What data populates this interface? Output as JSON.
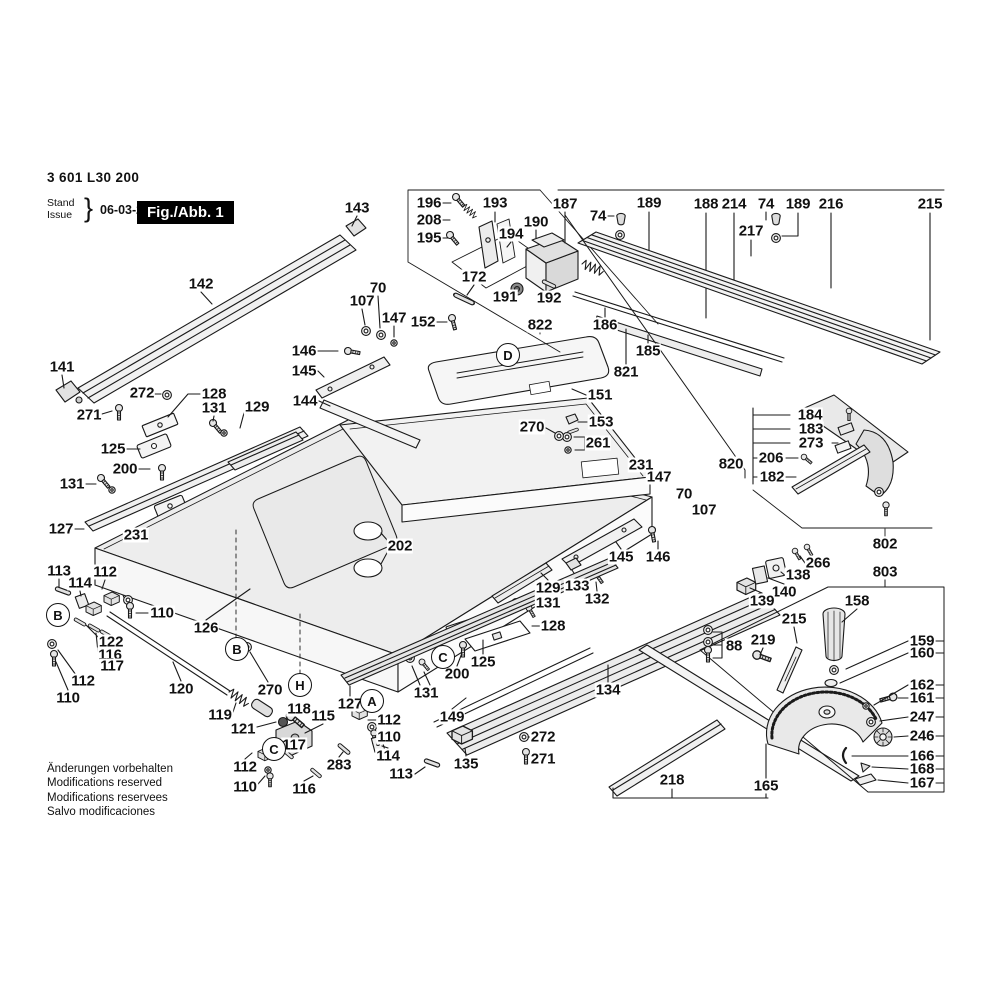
{
  "header": {
    "part_number": "3 601 L30 200",
    "stand_label": "Stand",
    "issue_label": "Issue",
    "brace": "}",
    "date": "06-03-21",
    "figure_label": "Fig./Abb. 1"
  },
  "footer": {
    "lines": [
      "Änderungen vorbehalten",
      "Modifications reserved",
      "Modifications reservees",
      "Salvo modificaciones"
    ]
  },
  "colors": {
    "ink": "#1a1a1a",
    "paper": "#ffffff",
    "badge_bg": "#000000",
    "badge_fg": "#ffffff"
  },
  "part_labels": [
    {
      "t": "143",
      "x": 357,
      "y": 208
    },
    {
      "t": "196",
      "x": 429,
      "y": 203
    },
    {
      "t": "208",
      "x": 429,
      "y": 220
    },
    {
      "t": "195",
      "x": 429,
      "y": 238
    },
    {
      "t": "193",
      "x": 495,
      "y": 203
    },
    {
      "t": "190",
      "x": 536,
      "y": 222
    },
    {
      "t": "194",
      "x": 511,
      "y": 234
    },
    {
      "t": "187",
      "x": 565,
      "y": 204
    },
    {
      "t": "74",
      "x": 598,
      "y": 216
    },
    {
      "t": "189",
      "x": 649,
      "y": 203
    },
    {
      "t": "188",
      "x": 706,
      "y": 204
    },
    {
      "t": "214",
      "x": 734,
      "y": 204
    },
    {
      "t": "74",
      "x": 766,
      "y": 204
    },
    {
      "t": "189",
      "x": 798,
      "y": 204
    },
    {
      "t": "216",
      "x": 831,
      "y": 204
    },
    {
      "t": "215",
      "x": 930,
      "y": 204
    },
    {
      "t": "217",
      "x": 751,
      "y": 231
    },
    {
      "t": "172",
      "x": 474,
      "y": 277
    },
    {
      "t": "191",
      "x": 505,
      "y": 297
    },
    {
      "t": "192",
      "x": 549,
      "y": 298
    },
    {
      "t": "142",
      "x": 201,
      "y": 284
    },
    {
      "t": "70",
      "x": 378,
      "y": 288
    },
    {
      "t": "107",
      "x": 362,
      "y": 301
    },
    {
      "t": "147",
      "x": 394,
      "y": 318
    },
    {
      "t": "152",
      "x": 423,
      "y": 322
    },
    {
      "t": "822",
      "x": 540,
      "y": 325
    },
    {
      "t": "186",
      "x": 605,
      "y": 325
    },
    {
      "t": "185",
      "x": 648,
      "y": 351
    },
    {
      "t": "821",
      "x": 626,
      "y": 372
    },
    {
      "t": "146",
      "x": 304,
      "y": 351
    },
    {
      "t": "145",
      "x": 304,
      "y": 371
    },
    {
      "t": "144",
      "x": 305,
      "y": 401
    },
    {
      "t": "151",
      "x": 600,
      "y": 395
    },
    {
      "t": "153",
      "x": 601,
      "y": 422
    },
    {
      "t": "261",
      "x": 598,
      "y": 443
    },
    {
      "t": "270",
      "x": 532,
      "y": 427
    },
    {
      "t": "141",
      "x": 62,
      "y": 367
    },
    {
      "t": "272",
      "x": 142,
      "y": 393
    },
    {
      "t": "271",
      "x": 89,
      "y": 415
    },
    {
      "t": "128",
      "x": 214,
      "y": 394
    },
    {
      "t": "131",
      "x": 214,
      "y": 408
    },
    {
      "t": "129",
      "x": 257,
      "y": 407
    },
    {
      "t": "125",
      "x": 113,
      "y": 449
    },
    {
      "t": "200",
      "x": 125,
      "y": 469
    },
    {
      "t": "131",
      "x": 72,
      "y": 484
    },
    {
      "t": "127",
      "x": 61,
      "y": 529
    },
    {
      "t": "231",
      "x": 136,
      "y": 535
    },
    {
      "t": "231",
      "x": 641,
      "y": 465
    },
    {
      "t": "147",
      "x": 659,
      "y": 477
    },
    {
      "t": "70",
      "x": 684,
      "y": 494
    },
    {
      "t": "107",
      "x": 704,
      "y": 510
    },
    {
      "t": "820",
      "x": 731,
      "y": 464
    },
    {
      "t": "184",
      "x": 810,
      "y": 415
    },
    {
      "t": "183",
      "x": 811,
      "y": 429
    },
    {
      "t": "273",
      "x": 811,
      "y": 443
    },
    {
      "t": "206",
      "x": 771,
      "y": 458
    },
    {
      "t": "182",
      "x": 772,
      "y": 477
    },
    {
      "t": "802",
      "x": 885,
      "y": 544
    },
    {
      "t": "202",
      "x": 400,
      "y": 546
    },
    {
      "t": "145",
      "x": 621,
      "y": 557
    },
    {
      "t": "146",
      "x": 658,
      "y": 557
    },
    {
      "t": "133",
      "x": 577,
      "y": 586
    },
    {
      "t": "132",
      "x": 597,
      "y": 599
    },
    {
      "t": "129",
      "x": 548,
      "y": 588
    },
    {
      "t": "131",
      "x": 548,
      "y": 603
    },
    {
      "t": "128",
      "x": 553,
      "y": 626
    },
    {
      "t": "266",
      "x": 818,
      "y": 563
    },
    {
      "t": "138",
      "x": 798,
      "y": 575
    },
    {
      "t": "140",
      "x": 784,
      "y": 592
    },
    {
      "t": "139",
      "x": 762,
      "y": 601
    },
    {
      "t": "803",
      "x": 885,
      "y": 572
    },
    {
      "t": "158",
      "x": 857,
      "y": 601
    },
    {
      "t": "215",
      "x": 794,
      "y": 619
    },
    {
      "t": "219",
      "x": 763,
      "y": 640
    },
    {
      "t": "88",
      "x": 734,
      "y": 646
    },
    {
      "t": "113",
      "x": 59,
      "y": 571
    },
    {
      "t": "114",
      "x": 80,
      "y": 583
    },
    {
      "t": "112",
      "x": 105,
      "y": 572
    },
    {
      "t": "110",
      "x": 162,
      "y": 613
    },
    {
      "t": "122",
      "x": 111,
      "y": 642
    },
    {
      "t": "116",
      "x": 110,
      "y": 655
    },
    {
      "t": "117",
      "x": 112,
      "y": 666
    },
    {
      "t": "112",
      "x": 83,
      "y": 681
    },
    {
      "t": "110",
      "x": 68,
      "y": 698
    },
    {
      "t": "126",
      "x": 206,
      "y": 628
    },
    {
      "t": "120",
      "x": 181,
      "y": 689
    },
    {
      "t": "270",
      "x": 270,
      "y": 690
    },
    {
      "t": "119",
      "x": 220,
      "y": 715
    },
    {
      "t": "121",
      "x": 243,
      "y": 729
    },
    {
      "t": "118",
      "x": 299,
      "y": 709
    },
    {
      "t": "115",
      "x": 323,
      "y": 716
    },
    {
      "t": "117",
      "x": 294,
      "y": 745
    },
    {
      "t": "112",
      "x": 389,
      "y": 720
    },
    {
      "t": "110",
      "x": 389,
      "y": 737
    },
    {
      "t": "114",
      "x": 388,
      "y": 756
    },
    {
      "t": "283",
      "x": 339,
      "y": 765
    },
    {
      "t": "113",
      "x": 401,
      "y": 774
    },
    {
      "t": "112",
      "x": 245,
      "y": 767
    },
    {
      "t": "110",
      "x": 245,
      "y": 787
    },
    {
      "t": "116",
      "x": 304,
      "y": 789
    },
    {
      "t": "127",
      "x": 350,
      "y": 704
    },
    {
      "t": "131",
      "x": 426,
      "y": 693
    },
    {
      "t": "200",
      "x": 457,
      "y": 674
    },
    {
      "t": "125",
      "x": 483,
      "y": 662
    },
    {
      "t": "149",
      "x": 452,
      "y": 717
    },
    {
      "t": "135",
      "x": 466,
      "y": 764
    },
    {
      "t": "272",
      "x": 543,
      "y": 737
    },
    {
      "t": "271",
      "x": 543,
      "y": 759
    },
    {
      "t": "134",
      "x": 608,
      "y": 690
    },
    {
      "t": "218",
      "x": 672,
      "y": 780
    },
    {
      "t": "165",
      "x": 766,
      "y": 786
    },
    {
      "t": "159",
      "x": 922,
      "y": 641
    },
    {
      "t": "160",
      "x": 922,
      "y": 653
    },
    {
      "t": "162",
      "x": 922,
      "y": 685
    },
    {
      "t": "161",
      "x": 922,
      "y": 698
    },
    {
      "t": "247",
      "x": 922,
      "y": 717
    },
    {
      "t": "246",
      "x": 922,
      "y": 736
    },
    {
      "t": "166",
      "x": 922,
      "y": 756
    },
    {
      "t": "168",
      "x": 922,
      "y": 769
    },
    {
      "t": "167",
      "x": 922,
      "y": 783
    }
  ],
  "view_letters": [
    {
      "t": "D",
      "x": 508,
      "y": 355
    },
    {
      "t": "B",
      "x": 58,
      "y": 615
    },
    {
      "t": "B",
      "x": 237,
      "y": 649
    },
    {
      "t": "C",
      "x": 443,
      "y": 657
    },
    {
      "t": "H",
      "x": 300,
      "y": 685
    },
    {
      "t": "A",
      "x": 372,
      "y": 701
    },
    {
      "t": "C",
      "x": 274,
      "y": 749
    }
  ]
}
